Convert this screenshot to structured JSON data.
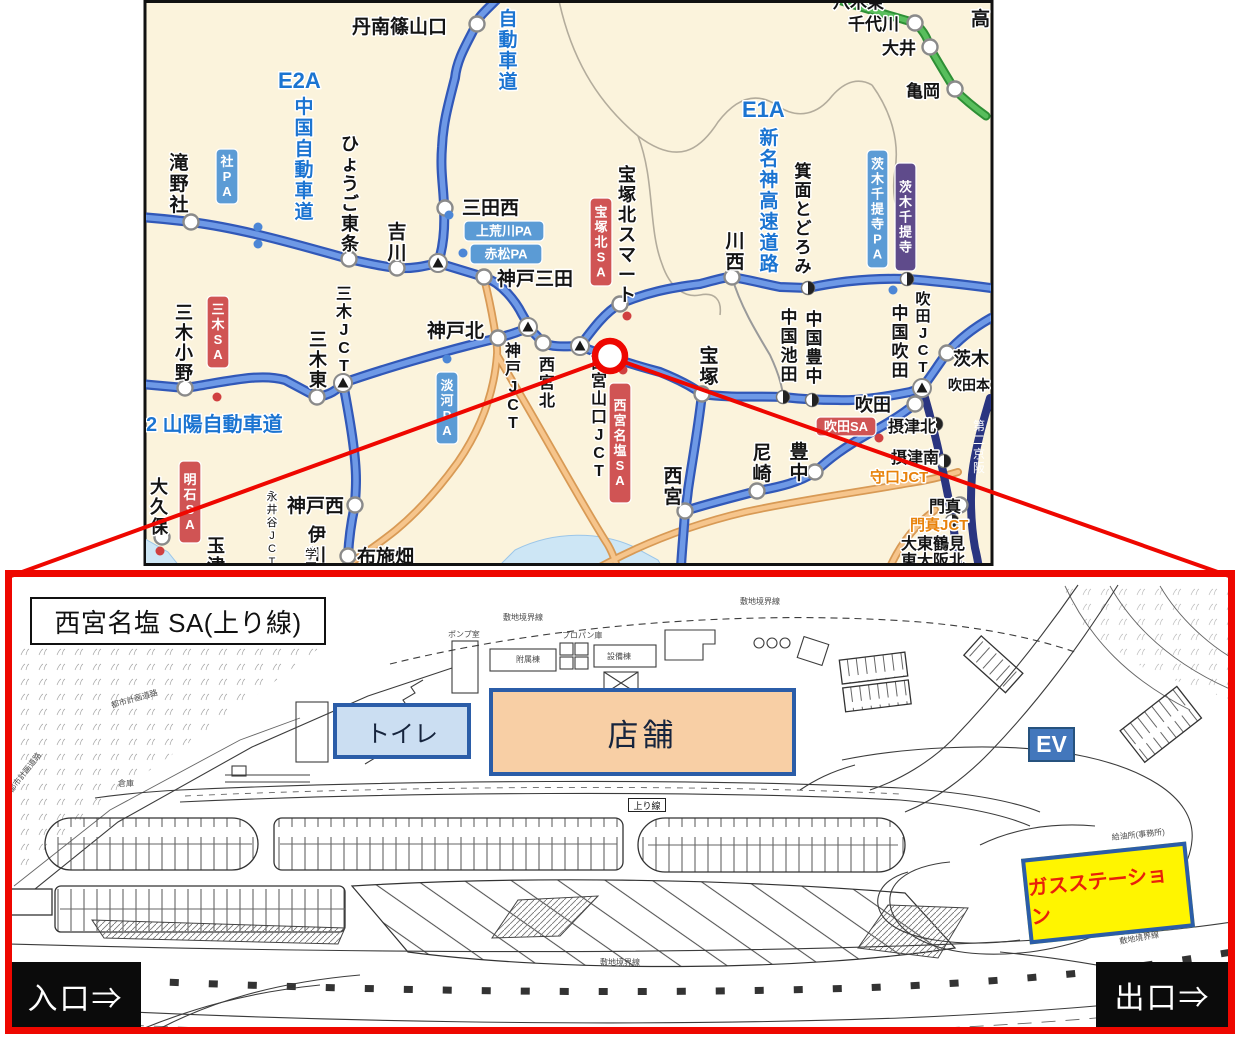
{
  "region_map": {
    "colors": {
      "map_bg": "#FBF3DC",
      "expressway_blue": "#3158B8",
      "road_orange": "#F6C58C",
      "road_green": "#58BE5C",
      "badge_blue": "#5B9BD5",
      "badge_red": "#D05454",
      "badge_purple": "#5F4B8B",
      "highlight_red": "#EE0700"
    },
    "labels": [
      {
        "t": "丹南篠山口",
        "x": 352,
        "y": 33,
        "s": 19
      },
      {
        "t": "八木東",
        "x": 833,
        "y": 8,
        "s": 17
      },
      {
        "t": "千代川",
        "x": 848,
        "y": 30,
        "s": 17
      },
      {
        "t": "大井",
        "x": 882,
        "y": 54,
        "s": 17
      },
      {
        "t": "亀岡",
        "x": 906,
        "y": 97,
        "s": 17
      },
      {
        "t": "高",
        "x": 971,
        "y": 25,
        "s": 19
      },
      {
        "t": "自動車道",
        "x": 508,
        "y": 6,
        "s": 19,
        "v": 1,
        "c": "b"
      },
      {
        "t": "E2A",
        "x": 278,
        "y": 88,
        "s": 22,
        "c": "b"
      },
      {
        "t": "中国自動車道",
        "x": 304,
        "y": 94,
        "s": 19,
        "v": 1,
        "c": "b"
      },
      {
        "t": "E1A",
        "x": 742,
        "y": 117,
        "s": 22,
        "c": "b"
      },
      {
        "t": "新名神高速道路",
        "x": 769,
        "y": 125,
        "s": 19,
        "v": 1,
        "c": "b"
      },
      {
        "t": "滝野社",
        "x": 179,
        "y": 150,
        "s": 19,
        "v": 1
      },
      {
        "t": "ひょうご東条",
        "x": 350,
        "y": 132,
        "s": 18,
        "v": 1
      },
      {
        "t": "吉川",
        "x": 397,
        "y": 219,
        "s": 19,
        "v": 1
      },
      {
        "t": "三田西",
        "x": 462,
        "y": 214,
        "s": 19
      },
      {
        "t": "神戸三田",
        "x": 497,
        "y": 285,
        "s": 19
      },
      {
        "t": "宝塚北スマート",
        "x": 627,
        "y": 163,
        "s": 18,
        "v": 1
      },
      {
        "t": "川西",
        "x": 735,
        "y": 228,
        "s": 19,
        "v": 1
      },
      {
        "t": "箕面とどろみ",
        "x": 803,
        "y": 160,
        "s": 17,
        "v": 1
      },
      {
        "t": "三木小野",
        "x": 184,
        "y": 301,
        "s": 18,
        "v": 1
      },
      {
        "t": "三木東",
        "x": 318,
        "y": 328,
        "s": 18,
        "v": 1
      },
      {
        "t": "三木JCT",
        "x": 344,
        "y": 283,
        "s": 16,
        "v": 1
      },
      {
        "t": "神戸北",
        "x": 427,
        "y": 337,
        "s": 19
      },
      {
        "t": "神戸JCT",
        "x": 513,
        "y": 340,
        "s": 16,
        "v": 1
      },
      {
        "t": "西宮北",
        "x": 547,
        "y": 354,
        "s": 16,
        "v": 1
      },
      {
        "t": "西宮山口JCT",
        "x": 599,
        "y": 352,
        "s": 16,
        "v": 1
      },
      {
        "t": "宝塚",
        "x": 709,
        "y": 343,
        "s": 19,
        "v": 1
      },
      {
        "t": "2 山陽自動車道",
        "x": 146,
        "y": 431,
        "s": 20,
        "c": "b"
      },
      {
        "t": "大久保",
        "x": 159,
        "y": 475,
        "s": 18,
        "v": 1
      },
      {
        "t": "玉津",
        "x": 216,
        "y": 534,
        "s": 18,
        "v": 1
      },
      {
        "t": "伊川谷",
        "x": 317,
        "y": 523,
        "s": 18,
        "v": 1
      },
      {
        "t": "永井谷JCT",
        "x": 272,
        "y": 489,
        "s": 11,
        "v": 1,
        "n": 1
      },
      {
        "t": "神戸西",
        "x": 287,
        "y": 512,
        "s": 19
      },
      {
        "t": "布施畑",
        "x": 357,
        "y": 563,
        "s": 19
      },
      {
        "t": "学園",
        "x": 311,
        "y": 546,
        "s": 12,
        "v": 1,
        "n": 1
      },
      {
        "t": "西宮",
        "x": 673,
        "y": 463,
        "s": 19,
        "v": 1
      },
      {
        "t": "尼崎",
        "x": 762,
        "y": 440,
        "s": 19,
        "v": 1
      },
      {
        "t": "豊中",
        "x": 799,
        "y": 439,
        "s": 19,
        "v": 1
      },
      {
        "t": "中国池田",
        "x": 789,
        "y": 306,
        "s": 17,
        "v": 1
      },
      {
        "t": "中国豊中",
        "x": 814,
        "y": 308,
        "s": 17,
        "v": 1
      },
      {
        "t": "中国吹田",
        "x": 900,
        "y": 302,
        "s": 17,
        "v": 1
      },
      {
        "t": "吹田JCT",
        "x": 923,
        "y": 289,
        "s": 15,
        "v": 1
      },
      {
        "t": "吹田",
        "x": 855,
        "y": 411,
        "s": 18
      },
      {
        "t": "茨木",
        "x": 953,
        "y": 365,
        "s": 18
      },
      {
        "t": "吹田本",
        "x": 948,
        "y": 390,
        "s": 14
      },
      {
        "t": "摂津北",
        "x": 888,
        "y": 432,
        "s": 16
      },
      {
        "t": "摂津南",
        "x": 891,
        "y": 463,
        "s": 16
      },
      {
        "t": "守口JCT",
        "x": 870,
        "y": 482,
        "s": 15,
        "c": "o"
      },
      {
        "t": "門真",
        "x": 929,
        "y": 512,
        "s": 16
      },
      {
        "t": "門真JCT",
        "x": 910,
        "y": 530,
        "s": 15,
        "c": "o"
      },
      {
        "t": "大東鶴見",
        "x": 901,
        "y": 549,
        "s": 16
      },
      {
        "t": "東大阪北",
        "x": 901,
        "y": 566,
        "s": 16
      },
      {
        "t": "第二京阪",
        "x": 979,
        "y": 418,
        "s": 12,
        "v": 1,
        "c": "w",
        "n": 1
      }
    ],
    "badges": [
      {
        "t": "社PA",
        "x": 216,
        "y": 149,
        "w": 22,
        "h": 55,
        "v": 1,
        "c": "pa"
      },
      {
        "t": "上荒川PA",
        "x": 464,
        "y": 221,
        "w": 80,
        "h": 20,
        "c": "pa"
      },
      {
        "t": "赤松PA",
        "x": 470,
        "y": 244,
        "w": 72,
        "h": 20,
        "c": "pa"
      },
      {
        "t": "淡河PA",
        "x": 436,
        "y": 372,
        "w": 22,
        "h": 72,
        "v": 1,
        "c": "pa"
      },
      {
        "t": "茨木千提寺PA",
        "x": 867,
        "y": 150,
        "w": 21,
        "h": 118,
        "v": 1,
        "c": "pa"
      },
      {
        "t": "茨木千提寺",
        "x": 895,
        "y": 163,
        "w": 21,
        "h": 108,
        "v": 1,
        "c": "ic"
      },
      {
        "t": "三木SA",
        "x": 207,
        "y": 296,
        "w": 22,
        "h": 72,
        "v": 1,
        "c": "sa"
      },
      {
        "t": "明石SA",
        "x": 179,
        "y": 461,
        "w": 22,
        "h": 82,
        "v": 1,
        "c": "sa"
      },
      {
        "t": "宝塚北SA",
        "x": 590,
        "y": 198,
        "w": 22,
        "h": 88,
        "v": 1,
        "c": "sa"
      },
      {
        "t": "西宮名塩SA",
        "x": 609,
        "y": 383,
        "w": 22,
        "h": 120,
        "v": 1,
        "c": "sa"
      },
      {
        "t": "吹田SA",
        "x": 816,
        "y": 417,
        "w": 60,
        "h": 19,
        "c": "sa"
      }
    ],
    "markers": {
      "ic": [
        [
          477,
          24
        ],
        [
          915,
          23
        ],
        [
          930,
          47
        ],
        [
          955,
          89
        ],
        [
          191,
          222
        ],
        [
          349,
          259
        ],
        [
          397,
          268
        ],
        [
          445,
          208
        ],
        [
          484,
          277
        ],
        [
          185,
          388
        ],
        [
          317,
          397
        ],
        [
          498,
          338
        ],
        [
          543,
          343
        ],
        [
          620,
          304
        ],
        [
          732,
          277
        ],
        [
          702,
          394
        ],
        [
          355,
          505
        ],
        [
          348,
          556
        ],
        [
          162,
          537
        ],
        [
          685,
          511
        ],
        [
          757,
          491
        ],
        [
          815,
          472
        ],
        [
          915,
          404
        ],
        [
          947,
          353
        ],
        [
          960,
          505
        ]
      ],
      "jct": [
        [
          438,
          263
        ],
        [
          528,
          327
        ],
        [
          580,
          346
        ],
        [
          343,
          383
        ],
        [
          922,
          388
        ]
      ],
      "tb": [
        [
          783,
          397
        ],
        [
          812,
          400
        ],
        [
          808,
          288
        ],
        [
          907,
          279
        ],
        [
          936,
          424
        ],
        [
          944,
          461
        ],
        [
          952,
          521
        ]
      ],
      "pa_dots": [
        [
          258,
          227
        ],
        [
          258,
          244
        ],
        [
          449,
          215
        ],
        [
          463,
          253
        ],
        [
          447,
          359
        ],
        [
          893,
          290
        ]
      ],
      "sa_dots": [
        [
          217,
          397
        ],
        [
          627,
          316
        ],
        [
          879,
          438
        ],
        [
          160,
          551
        ],
        [
          623,
          370
        ]
      ]
    }
  },
  "site_plan": {
    "title": "西宮名塩 SA(上り線)",
    "toilet_label": "トイレ",
    "shop_label": "店舗",
    "ev_label": "EV",
    "gas_label": "ガスステーション",
    "entrance_label": "入口⇒",
    "exit_label": "出口⇒",
    "lane_label": "上り線",
    "colors": {
      "shop_fill": "#F8CFA5",
      "toilet_fill": "#CBDEF2",
      "box_border": "#2B5DA8",
      "gas_fill": "#FFF500",
      "gas_text": "#E8210A",
      "sign_bg": "#0B0B0B",
      "ev_fill": "#4377BC"
    },
    "small_labels": [
      {
        "t": "敷地境界線",
        "x": 503,
        "y": 620,
        "s": 8
      },
      {
        "t": "敷地境界線",
        "x": 740,
        "y": 604,
        "s": 8
      },
      {
        "t": "敷地境界線",
        "x": 1120,
        "y": 944,
        "s": 8,
        "r": -10
      },
      {
        "t": "敷地境界線",
        "x": 600,
        "y": 965,
        "s": 8
      },
      {
        "t": "都市計画道路",
        "x": 112,
        "y": 708,
        "s": 8,
        "r": -16
      },
      {
        "t": "都市計画道路",
        "x": 12,
        "y": 793,
        "s": 8,
        "r": -52
      },
      {
        "t": "ポンプ室",
        "x": 448,
        "y": 637,
        "s": 8
      },
      {
        "t": "附属棟",
        "x": 516,
        "y": 662,
        "s": 8
      },
      {
        "t": "プロパン庫",
        "x": 562,
        "y": 638,
        "s": 8
      },
      {
        "t": "設備棟",
        "x": 607,
        "y": 659,
        "s": 8
      },
      {
        "t": "倉庫",
        "x": 118,
        "y": 786,
        "s": 8
      },
      {
        "t": "給油所(事務所)",
        "x": 1112,
        "y": 840,
        "s": 8,
        "r": -6
      }
    ]
  }
}
